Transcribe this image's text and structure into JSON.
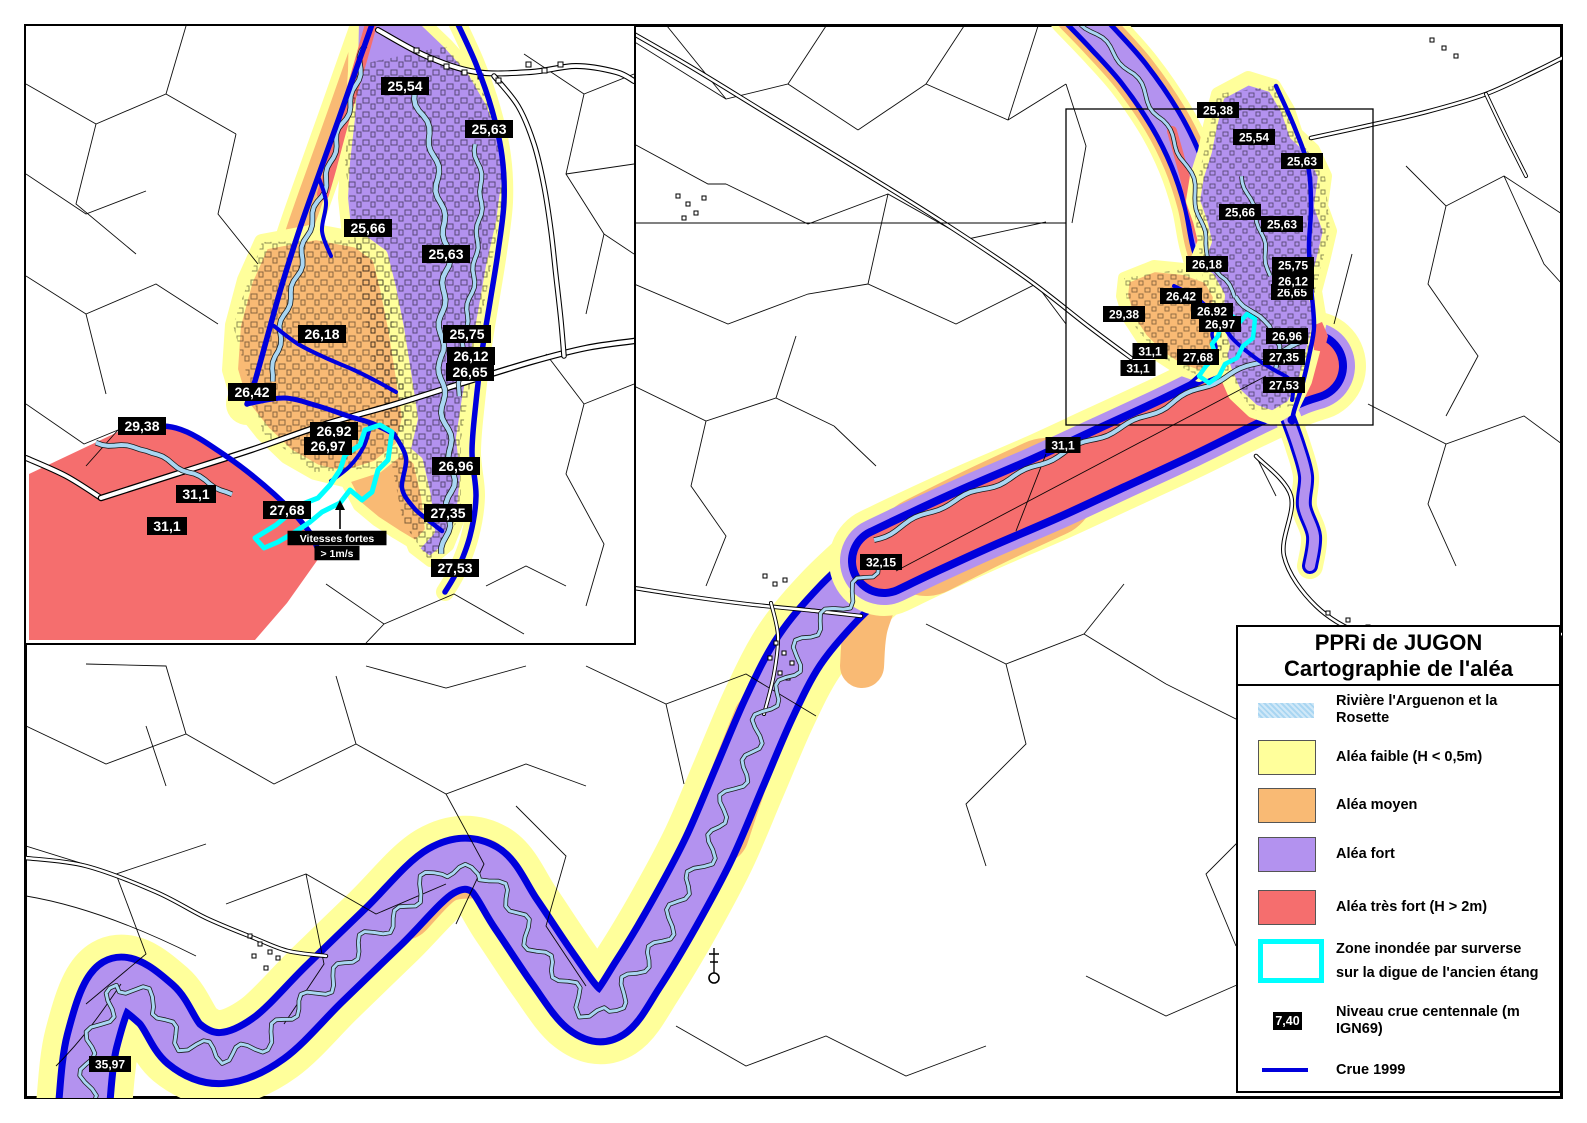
{
  "title": {
    "line1": "PPRi de JUGON",
    "line2": "Cartographie de l'aléa"
  },
  "colors": {
    "faible": "#FFFF9B",
    "moyen": "#F9BA74",
    "fort": "#B392EF",
    "tres_fort": "#F56E6E",
    "riviere": "#A9D6F2",
    "crue": "#0000DC",
    "surverse": "#00FFFF",
    "label_bg": "#000000",
    "label_text": "#FFFFFF",
    "linework": "#000000"
  },
  "legend": {
    "river": {
      "label": "Rivière l'Arguenon et la Rosette"
    },
    "faible": {
      "label": "Aléa faible (H < 0,5m)"
    },
    "moyen": {
      "label": "Aléa moyen"
    },
    "fort": {
      "label": "Aléa fort"
    },
    "tres_fort": {
      "label": "Aléa très fort (H > 2m)"
    },
    "surverse": {
      "line1": "Zone inondée par surverse",
      "line2": "sur la digue de l'ancien étang"
    },
    "niveau": {
      "sample": "7,40",
      "label": "Niveau crue centennale (m IGN69)"
    },
    "crue": {
      "label": "Crue 1999"
    }
  },
  "annotations": {
    "vitesses_line1": "Vitesses fortes",
    "vitesses_line2": "> 1m/s"
  },
  "inset_labels": [
    {
      "t": "25,54",
      "x": 379,
      "y": 60
    },
    {
      "t": "25,63",
      "x": 463,
      "y": 103
    },
    {
      "t": "25,66",
      "x": 342,
      "y": 202
    },
    {
      "t": "25,63",
      "x": 420,
      "y": 228
    },
    {
      "t": "26,18",
      "x": 296,
      "y": 308
    },
    {
      "t": "25,75",
      "x": 441,
      "y": 308
    },
    {
      "t": "26,65",
      "x": 444,
      "y": 346
    },
    {
      "t": "26,12",
      "x": 445,
      "y": 330
    },
    {
      "t": "26,42",
      "x": 226,
      "y": 366
    },
    {
      "t": "29,38",
      "x": 116,
      "y": 400
    },
    {
      "t": "26,92",
      "x": 308,
      "y": 405
    },
    {
      "t": "26,97",
      "x": 302,
      "y": 420
    },
    {
      "t": "31,1",
      "x": 170,
      "y": 468
    },
    {
      "t": "31,1",
      "x": 141,
      "y": 500
    },
    {
      "t": "27,68",
      "x": 261,
      "y": 484
    },
    {
      "t": "26,96",
      "x": 430,
      "y": 440
    },
    {
      "t": "27,35",
      "x": 422,
      "y": 487
    },
    {
      "t": "27,53",
      "x": 429,
      "y": 542
    }
  ],
  "main_labels": [
    {
      "t": "25,38",
      "x": 1192,
      "y": 84
    },
    {
      "t": "25,54",
      "x": 1228,
      "y": 111
    },
    {
      "t": "25,63",
      "x": 1276,
      "y": 135
    },
    {
      "t": "25,66",
      "x": 1214,
      "y": 186
    },
    {
      "t": "25,63",
      "x": 1256,
      "y": 198
    },
    {
      "t": "26,18",
      "x": 1181,
      "y": 238
    },
    {
      "t": "25,75",
      "x": 1267,
      "y": 239
    },
    {
      "t": "26,65",
      "x": 1266,
      "y": 266
    },
    {
      "t": "26,12",
      "x": 1267,
      "y": 255
    },
    {
      "t": "26,42",
      "x": 1155,
      "y": 270
    },
    {
      "t": "29,38",
      "x": 1098,
      "y": 288
    },
    {
      "t": "26,92",
      "x": 1186,
      "y": 285
    },
    {
      "t": "26,97",
      "x": 1194,
      "y": 298
    },
    {
      "t": "26,96",
      "x": 1261,
      "y": 310
    },
    {
      "t": "27,35",
      "x": 1258,
      "y": 331
    },
    {
      "t": "27,53",
      "x": 1258,
      "y": 359
    },
    {
      "t": "27,68",
      "x": 1172,
      "y": 331
    },
    {
      "t": "31,1",
      "x": 1124,
      "y": 325
    },
    {
      "t": "31,1",
      "x": 1112,
      "y": 342
    },
    {
      "t": "31,1",
      "x": 1037,
      "y": 419
    },
    {
      "t": "32,15",
      "x": 855,
      "y": 536
    },
    {
      "t": "35,97",
      "x": 84,
      "y": 1038
    }
  ]
}
